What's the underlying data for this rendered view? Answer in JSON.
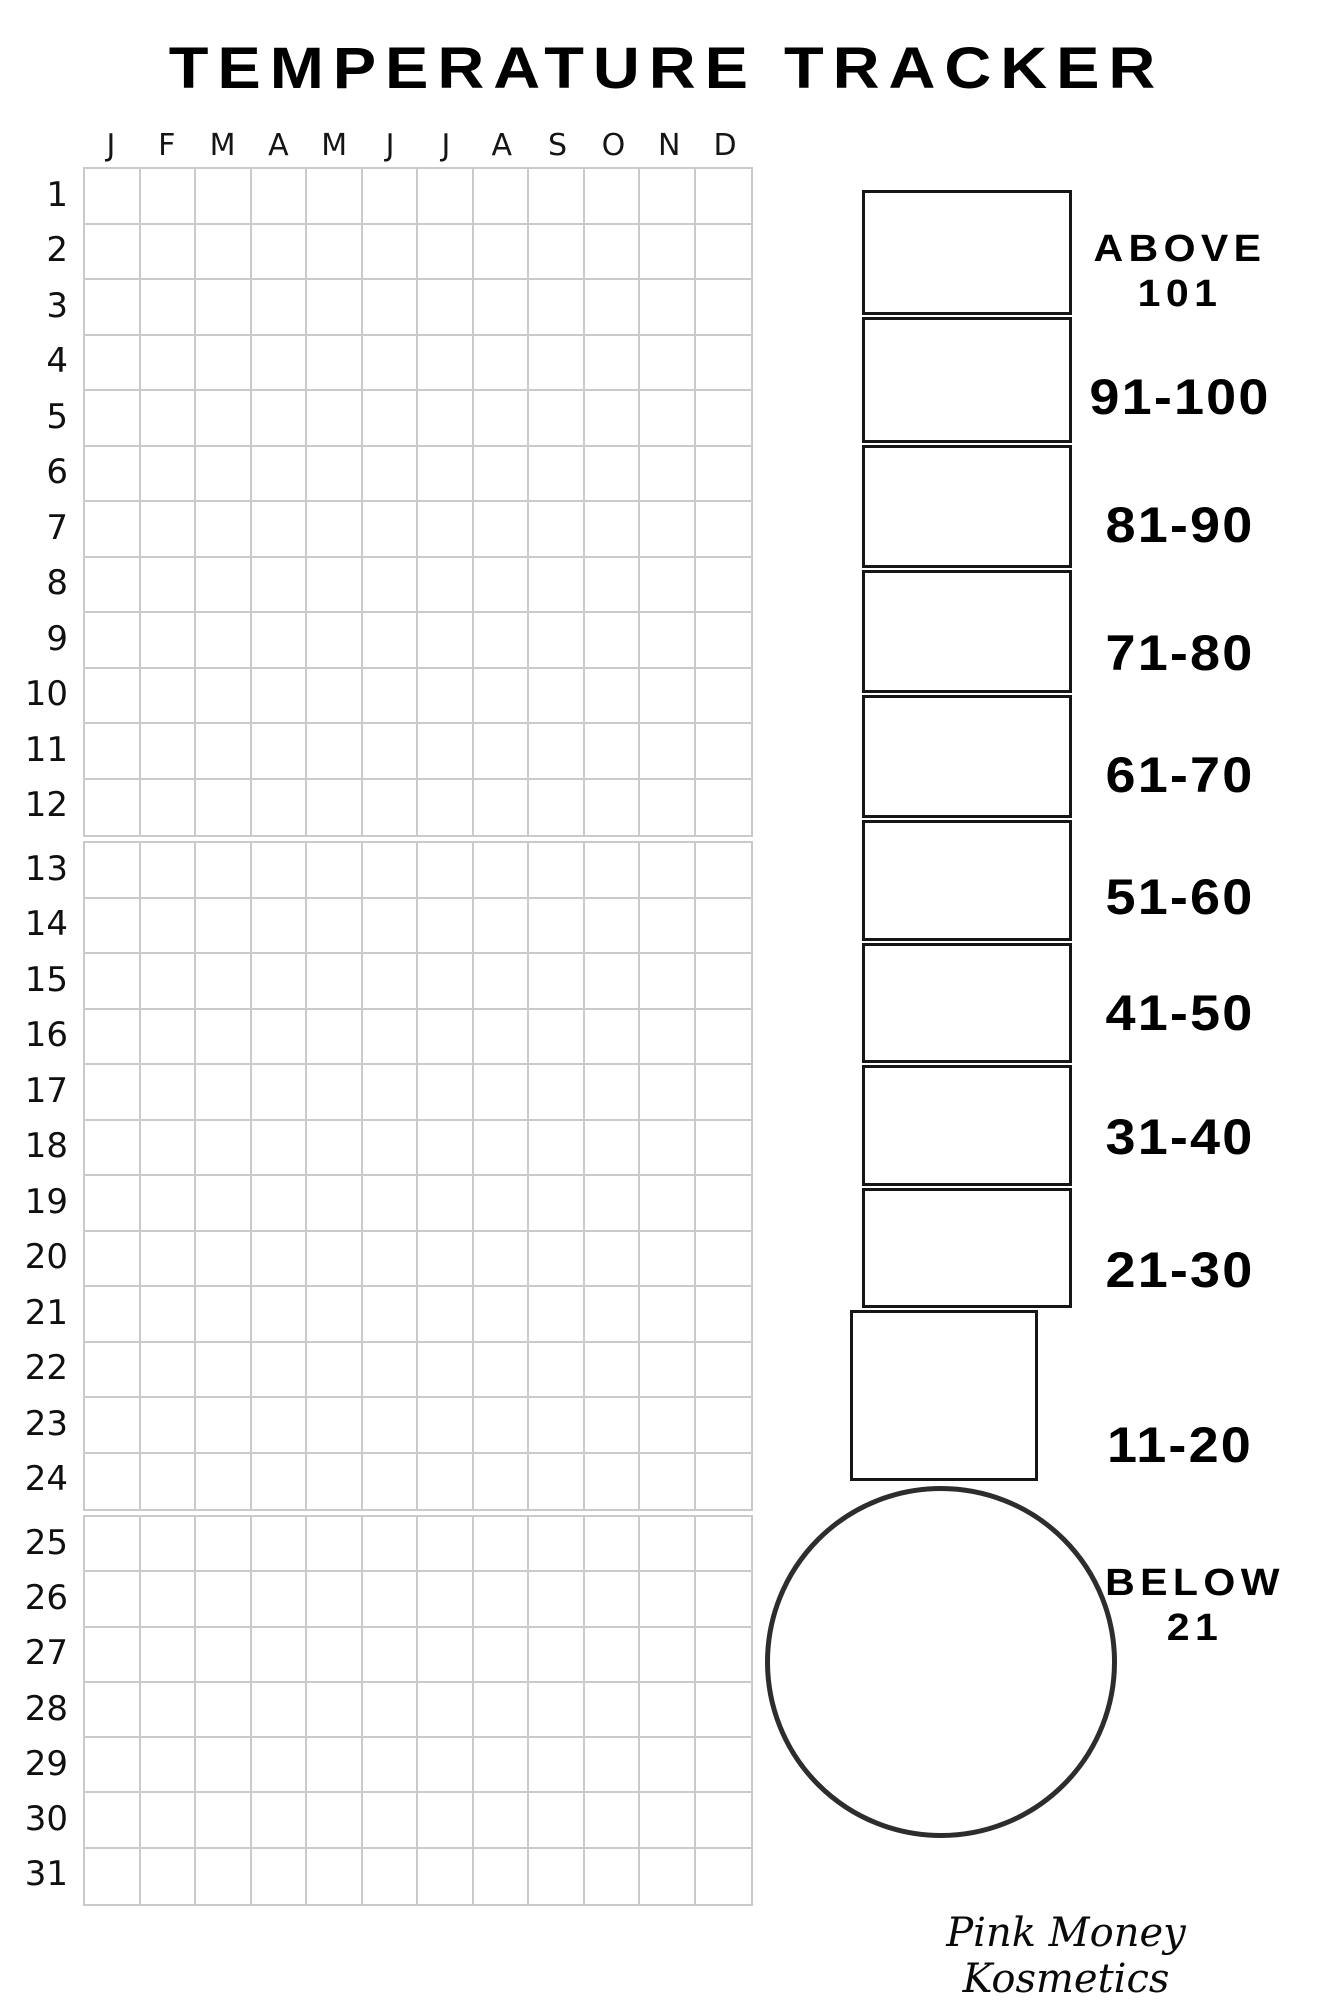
{
  "page": {
    "title": "TEMPERATURE TRACKER",
    "footer": "Pink Money Kosmetics"
  },
  "grid": {
    "months": [
      "J",
      "F",
      "M",
      "A",
      "M",
      "J",
      "J",
      "A",
      "S",
      "O",
      "N",
      "D"
    ],
    "day_rows": [
      [
        1,
        2,
        3,
        4,
        5,
        6,
        7,
        8,
        9,
        10,
        11,
        12
      ],
      [
        13,
        14,
        15,
        16,
        17,
        18,
        19,
        20,
        21,
        22,
        23,
        24
      ],
      [
        25,
        26,
        27,
        28,
        29,
        30,
        31
      ]
    ]
  },
  "thermometer": {
    "ranges": [
      {
        "label": "ABOVE 101",
        "lines": [
          "ABOVE",
          "101"
        ]
      },
      {
        "label": "91-100"
      },
      {
        "label": "81-90"
      },
      {
        "label": "71-80"
      },
      {
        "label": "61-70"
      },
      {
        "label": "51-60"
      },
      {
        "label": "41-50"
      },
      {
        "label": "31-40"
      },
      {
        "label": "21-30"
      },
      {
        "label": "11-20"
      },
      {
        "label": "BELOW 21",
        "lines": [
          "BELOW",
          "21"
        ]
      }
    ]
  },
  "colors": {
    "text": "#000000",
    "grid_line": "#cacaca",
    "tube_border": "#161616",
    "bulb_border": "#2d2d2d"
  }
}
